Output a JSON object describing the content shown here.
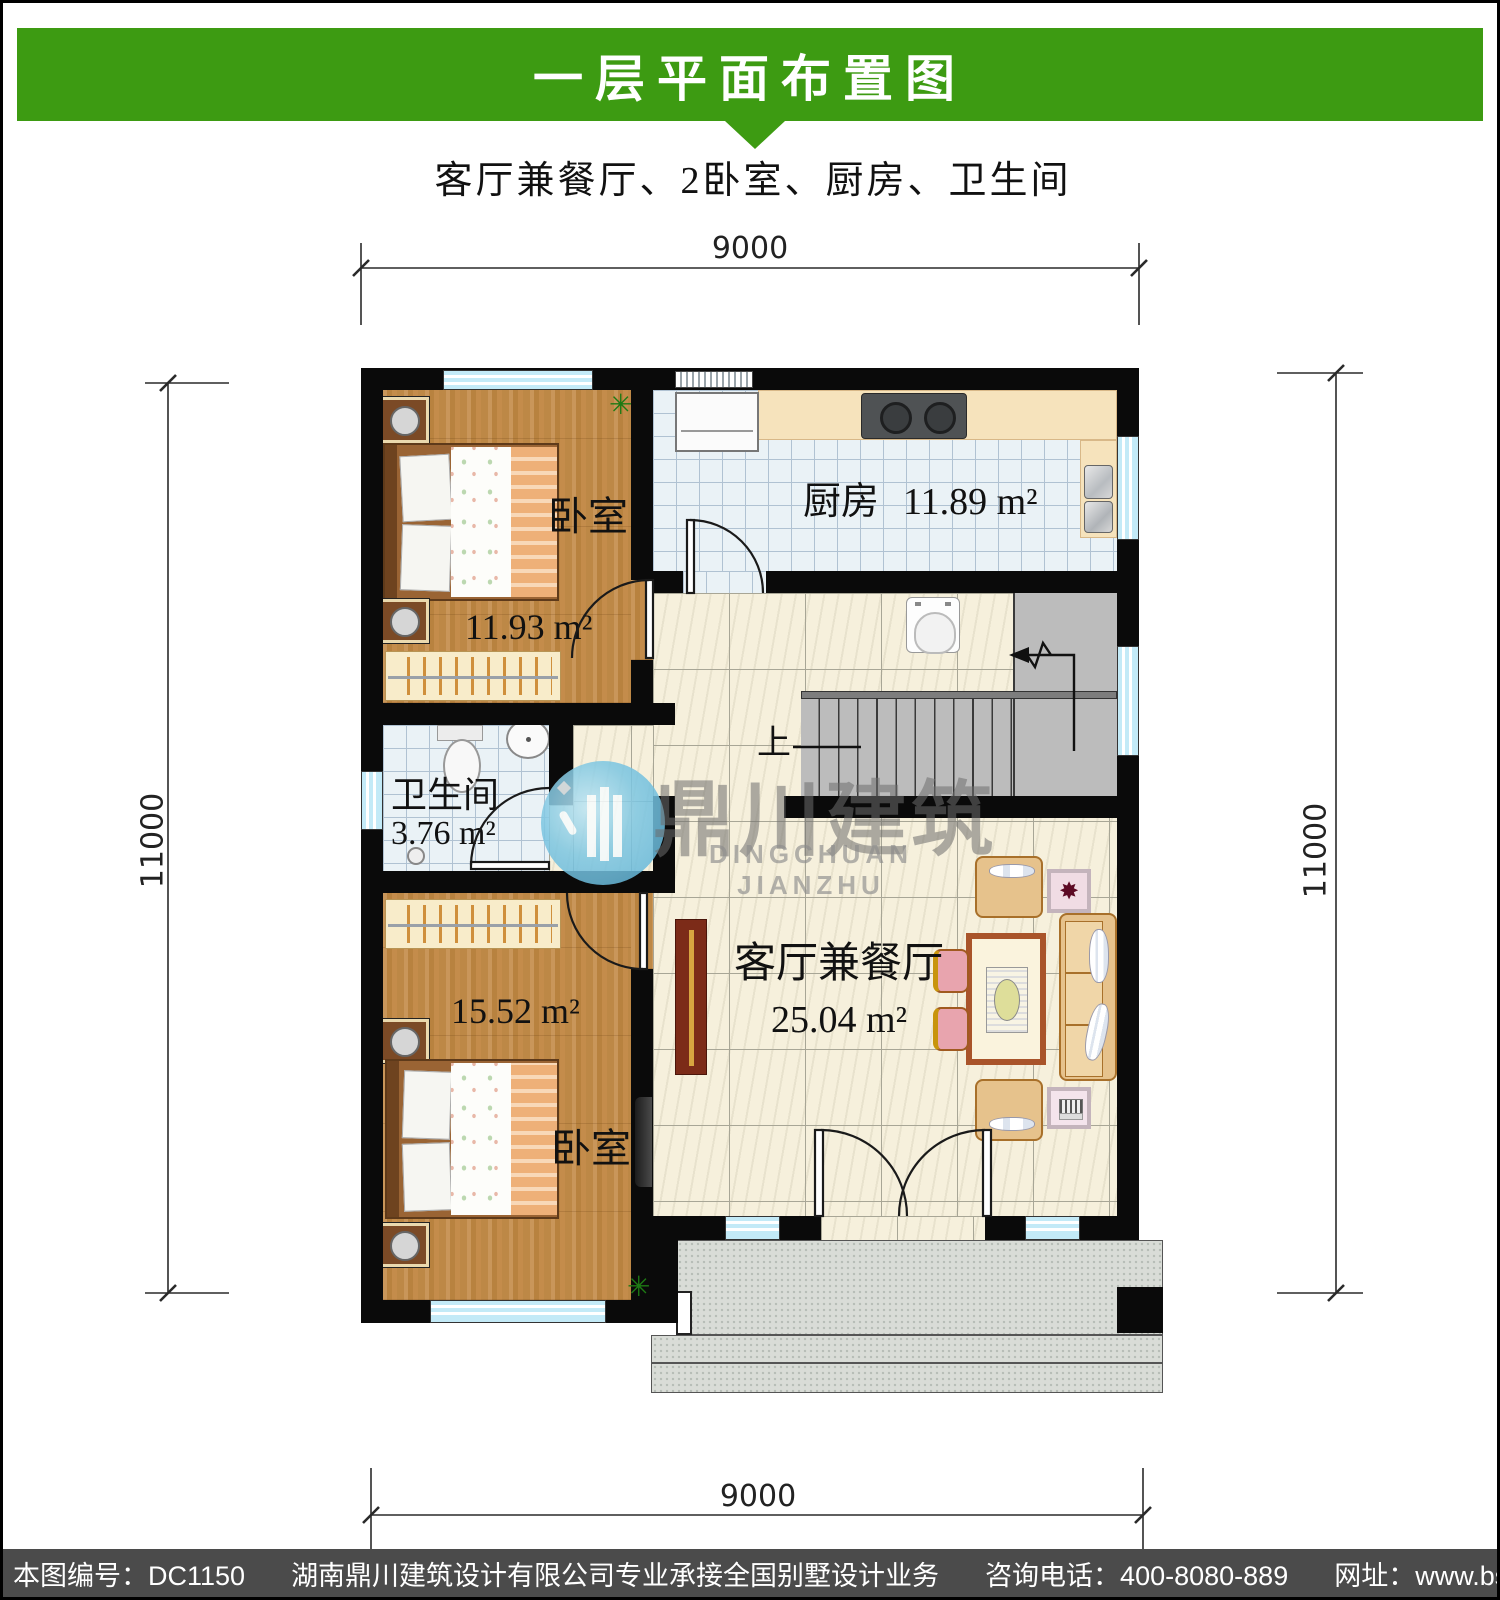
{
  "header": {
    "title": "一层平面布置图",
    "bg_color": "#3d9b12",
    "text_color": "#ffffff"
  },
  "subtitle": "客厅兼餐厅、2卧室、厨房、卫生间",
  "dimensions": {
    "top": "9000",
    "bottom": "9000",
    "left": "11000",
    "right": "11000"
  },
  "rooms": {
    "bedroom_top": {
      "name": "卧室",
      "area": "11.93 m²"
    },
    "kitchen": {
      "name": "厨房",
      "area": "11.89 m²"
    },
    "bathroom": {
      "name": "卫生间",
      "area": "3.76 m²"
    },
    "bedroom_bottom": {
      "name": "卧室",
      "area": "15.52 m²"
    },
    "living_dining": {
      "name": "客厅兼餐厅",
      "area": "25.04 m²"
    }
  },
  "stairs": {
    "up_label": "上"
  },
  "watermark": {
    "cn": "鼎川建筑",
    "en": "DINGCHUAN JIANZHU",
    "logo_color": "#62b8dc"
  },
  "icons": {
    "plant": "✳",
    "flower_art": "✸"
  },
  "footer": {
    "bg_color": "#4b4b4b",
    "parts": [
      "本图编号：DC1150",
      "湖南鼎川建筑设计有限公司专业承接全国别墅设计业务",
      "咨询电话：400-8080-889",
      "网址：www.bstzcs.com"
    ]
  }
}
